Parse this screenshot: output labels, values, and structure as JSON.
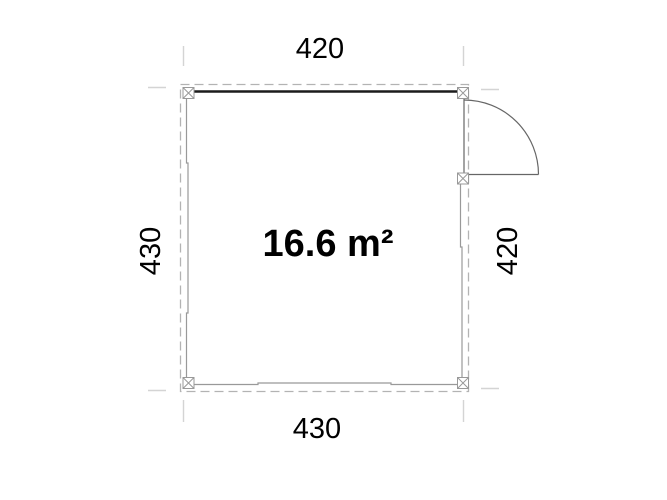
{
  "page": {
    "background": "#ffffff"
  },
  "plan": {
    "area_label": "16.6 m²",
    "dimensions": {
      "top": "420",
      "right": "420",
      "bottom": "430",
      "left": "430"
    }
  },
  "colors": {
    "text": "#000000",
    "thick_wall": "#1c1c1c",
    "thin_wall": "#999999",
    "dashed_outline": "#b3b3b3",
    "door": "#666666",
    "extension_line": "#d4d4d4",
    "marker_fill": "#ffffff"
  }
}
